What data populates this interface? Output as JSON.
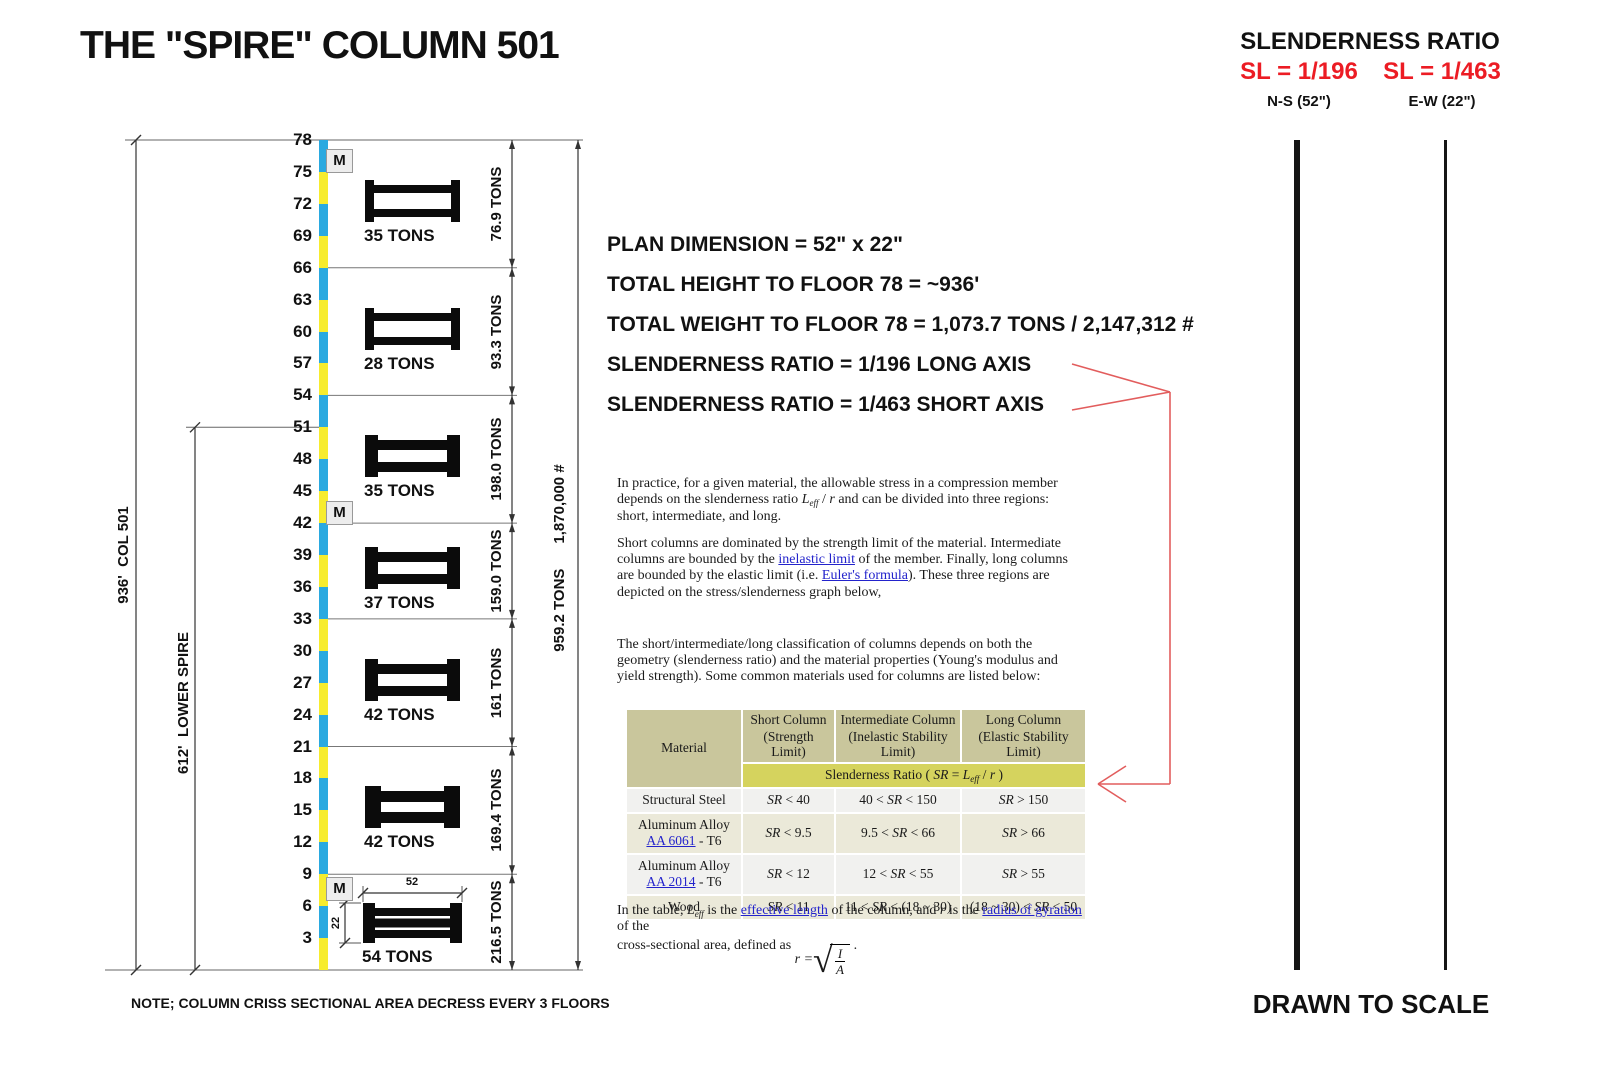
{
  "title": "THE \"SPIRE\" COLUMN 501",
  "slenderness_panel": {
    "heading": "SLENDERNESS RATIO",
    "sl_long": "SL = 1/196",
    "sl_short": "SL = 1/463",
    "ns_label": "N-S (52\")",
    "ew_label": "E-W (22\")",
    "accent_red": "#ec1c24",
    "drawn_to_scale": "DRAWN TO SCALE"
  },
  "stats": [
    "PLAN DIMENSION = 52\" x 22\"",
    "TOTAL HEIGHT TO FLOOR 78 = ~936'",
    "TOTAL WEIGHT TO FLOOR 78 = 1,073.7 TONS / 2,147,312 #",
    "SLENDERNESS RATIO = 1/196 LONG AXIS",
    "SLENDERNESS RATIO = 1/463 SHORT AXIS"
  ],
  "diagram": {
    "colors": {
      "blue": "#2aa9e0",
      "yellow": "#f7ec2e",
      "red_line": "#e25d5d"
    },
    "floor_labels": [
      78,
      75,
      72,
      69,
      66,
      63,
      60,
      57,
      54,
      51,
      48,
      45,
      42,
      39,
      36,
      33,
      30,
      27,
      24,
      21,
      18,
      15,
      12,
      9,
      6,
      3
    ],
    "marker_label": "M",
    "marker_floors": [
      78,
      45,
      9
    ],
    "left_dim_total": "936'  COL 501",
    "left_dim_lower": "612'  LOWER SPIRE",
    "lower_spire_top_floor": 51,
    "right_total": "959.2 TONS      1,870,000 #",
    "bottom_dims": {
      "width": "52",
      "depth": "22"
    },
    "note": "NOTE; COLUMN CRISS SECTIONAL AREA DECRESS EVERY 3 FLOORS",
    "sections": [
      {
        "top_floor": 78,
        "bottom_floor": 66,
        "unit_weight": "35 TONS",
        "section_weight": "76.9 TONS",
        "glyph": "light"
      },
      {
        "top_floor": 66,
        "bottom_floor": 54,
        "unit_weight": "28 TONS",
        "section_weight": "93.3 TONS",
        "glyph": "light"
      },
      {
        "top_floor": 54,
        "bottom_floor": 42,
        "unit_weight": "35 TONS",
        "section_weight": "198.0 TONS",
        "glyph": "medium"
      },
      {
        "top_floor": 42,
        "bottom_floor": 33,
        "unit_weight": "37 TONS",
        "section_weight": "159.0 TONS",
        "glyph": "medium"
      },
      {
        "top_floor": 33,
        "bottom_floor": 21,
        "unit_weight": "42 TONS",
        "section_weight": "161 TONS",
        "glyph": "medium"
      },
      {
        "top_floor": 21,
        "bottom_floor": 9,
        "unit_weight": "42 TONS",
        "section_weight": "169.4 TONS",
        "glyph": "thick"
      },
      {
        "top_floor": 9,
        "bottom_floor": 0,
        "unit_weight": "54 TONS",
        "section_weight": "216.5 TONS",
        "glyph": "heavy"
      }
    ]
  },
  "article": {
    "paragraphs": [
      [
        {
          "t": "In practice, for a given material, the allowable stress in a compression member depends on the slenderness ratio "
        },
        {
          "t": "L",
          "i": true
        },
        {
          "t": "eff",
          "sub": true
        },
        {
          "t": " / "
        },
        {
          "t": "r",
          "i": true
        },
        {
          "t": " and can be divided into three regions: short, intermediate, and long."
        }
      ],
      [
        {
          "t": "Short columns are dominated by the strength limit of the material. Intermediate columns are bounded by the "
        },
        {
          "t": "inelastic limit",
          "link": true
        },
        {
          "t": " of the member. Finally, long columns are bounded by the elastic limit (i.e. "
        },
        {
          "t": "Euler's formula",
          "link": true
        },
        {
          "t": "). These three regions are depicted on the stress/slenderness graph below,"
        }
      ],
      [
        {
          "t": "The short/intermediate/long classification of columns depends on both the geometry (slenderness ratio) and the material properties (Young's modulus and yield strength). Some common materials used for columns are listed below:"
        }
      ]
    ],
    "footer_line1": [
      {
        "t": "In the table, "
      },
      {
        "t": "L",
        "i": true
      },
      {
        "t": "eff",
        "sub": true
      },
      {
        "t": " is the "
      },
      {
        "t": "effective length",
        "link": true
      },
      {
        "t": " of the column, and "
      },
      {
        "t": "r",
        "i": true
      },
      {
        "t": " is the "
      },
      {
        "t": "radius of gyration",
        "link": true
      },
      {
        "t": " of the"
      }
    ],
    "footer_line2": [
      {
        "t": "cross-sectional area, defined as "
      }
    ],
    "formula": {
      "lhs": "r",
      "eq": " = ",
      "num": "I",
      "den": "A",
      "tail": " ."
    }
  },
  "table": {
    "header": {
      "material": "Material",
      "columns": [
        {
          "bold": "Short Column",
          "normal": "(Strength Limit)"
        },
        {
          "bold": "Intermediate Column",
          "normal": "(Inelastic Stability Limit)"
        },
        {
          "bold": "Long Column",
          "normal": "(Elastic Stability Limit)"
        }
      ],
      "span": [
        {
          "t": "Slenderness Ratio ( "
        },
        {
          "t": "SR",
          "i": true
        },
        {
          "t": " = "
        },
        {
          "t": "L",
          "i": true
        },
        {
          "t": "eff",
          "sub": true
        },
        {
          "t": " / "
        },
        {
          "t": "r",
          "i": true
        },
        {
          "t": " )"
        }
      ]
    },
    "rows": [
      {
        "material": [
          {
            "t": "Structural Steel"
          }
        ],
        "cells": [
          [
            {
              "t": "SR",
              "i": true
            },
            {
              "t": " < 40"
            }
          ],
          [
            {
              "t": "40 < "
            },
            {
              "t": "SR",
              "i": true
            },
            {
              "t": " < 150"
            }
          ],
          [
            {
              "t": "SR",
              "i": true
            },
            {
              "t": " > 150"
            }
          ]
        ]
      },
      {
        "material": [
          {
            "t": "Aluminum Alloy"
          },
          {
            "br": true
          },
          {
            "t": "AA 6061",
            "link": true
          },
          {
            "t": " - T6"
          }
        ],
        "cells": [
          [
            {
              "t": "SR",
              "i": true
            },
            {
              "t": " < 9.5"
            }
          ],
          [
            {
              "t": "9.5 < "
            },
            {
              "t": "SR",
              "i": true
            },
            {
              "t": " < 66"
            }
          ],
          [
            {
              "t": "SR",
              "i": true
            },
            {
              "t": " > 66"
            }
          ]
        ]
      },
      {
        "material": [
          {
            "t": "Aluminum Alloy"
          },
          {
            "br": true
          },
          {
            "t": "AA 2014",
            "link": true
          },
          {
            "t": " - T6"
          }
        ],
        "cells": [
          [
            {
              "t": "SR",
              "i": true
            },
            {
              "t": " < 12"
            }
          ],
          [
            {
              "t": "12 < "
            },
            {
              "t": "SR",
              "i": true
            },
            {
              "t": " < 55"
            }
          ],
          [
            {
              "t": "SR",
              "i": true
            },
            {
              "t": " > 55"
            }
          ]
        ]
      },
      {
        "material": [
          {
            "t": "Wood"
          }
        ],
        "cells": [
          [
            {
              "t": "SR",
              "i": true
            },
            {
              "t": " < 11"
            }
          ],
          [
            {
              "t": "11 < "
            },
            {
              "t": "SR",
              "i": true
            },
            {
              "t": " < (18 ~ 30)"
            }
          ],
          [
            {
              "t": "(18 ~ 30) < "
            },
            {
              "t": "SR",
              "i": true
            },
            {
              "t": " < 50"
            }
          ]
        ]
      }
    ]
  }
}
